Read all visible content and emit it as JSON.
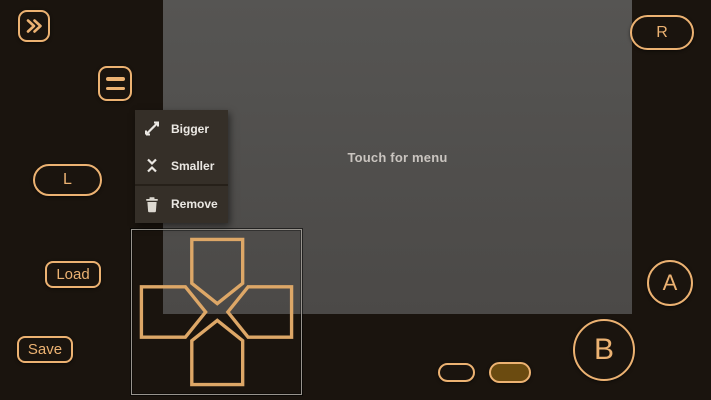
{
  "colors": {
    "background": "#1a140e",
    "accent": "#ecb272",
    "screen": "#555351",
    "screen_text": "#cac5c0",
    "menu_background": "#352f28",
    "menu_text": "#ebe8e3",
    "start_button_fill": "#6b4b10",
    "dpad_frame_border": "#98948e"
  },
  "screen": {
    "message": "Touch for menu"
  },
  "controls": {
    "fast_forward": {
      "icon": "fast-forward-icon"
    },
    "menu": {
      "icon": "hamburger-icon"
    },
    "shoulder_left": {
      "label": "L"
    },
    "shoulder_right": {
      "label": "R"
    },
    "load": {
      "label": "Load"
    },
    "save": {
      "label": "Save"
    },
    "button_a": {
      "label": "A"
    },
    "button_b": {
      "label": "B"
    },
    "select_pill": {
      "icon": "select-pill"
    },
    "start_pill": {
      "icon": "start-pill"
    },
    "dpad": {
      "directions": [
        "up",
        "right",
        "down",
        "left"
      ]
    }
  },
  "context_menu": {
    "items": [
      {
        "icon": "expand-icon",
        "label": "Bigger"
      },
      {
        "icon": "collapse-icon",
        "label": "Smaller"
      },
      {
        "icon": "trash-icon",
        "label": "Remove"
      }
    ]
  }
}
